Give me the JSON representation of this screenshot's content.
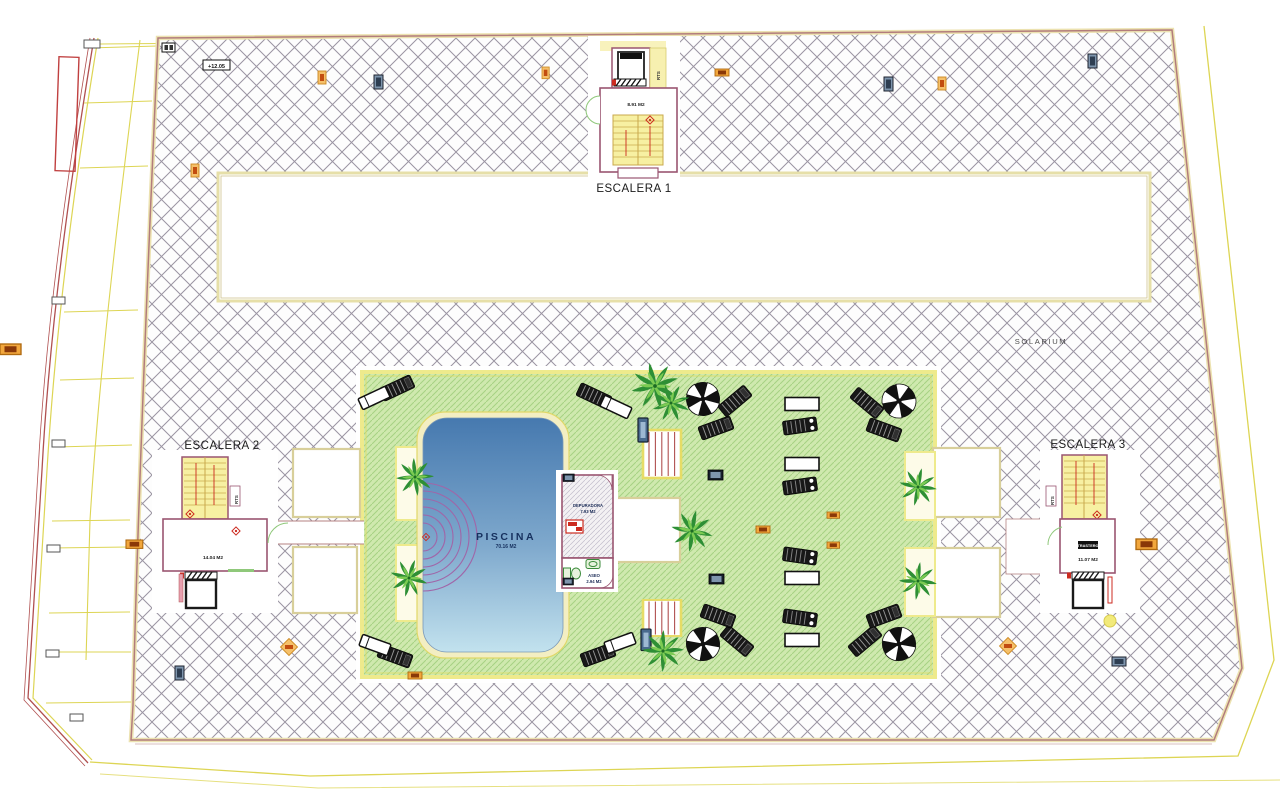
{
  "plan": {
    "solarium_label": "SOLARIUM",
    "piscina": {
      "title": "PISCINA",
      "area": "70.16 M2"
    },
    "escalera1": {
      "title": "ESCALERA 1",
      "area": "8.91 M2",
      "rts": "RTS"
    },
    "escalera2": {
      "title": "ESCALERA 2",
      "area": "14.04 M2",
      "rts": "RTS"
    },
    "escalera3": {
      "title": "ESCALERA 3",
      "area": "11.07 M2",
      "rts": "RTS",
      "storage": "TRASTERO"
    },
    "depuradora": {
      "title": "DEPURADORA",
      "area": "7.93 M2"
    },
    "aseo": {
      "title": "ASEO",
      "area": "2.94 M2"
    },
    "level_tag": "+12.05"
  },
  "colors": {
    "hatch_line": "#9a94a2",
    "boundary": "#b27c7c",
    "boundary_inner": "#ece2b0",
    "outer_yellow": "#ddd554",
    "green_fill": "#cfe9ae",
    "green_line": "#a6d283",
    "green_border": "#eeea8c",
    "pool_top": "#4a7bb2",
    "pool_bottom": "#bddfee",
    "pool_border": "#f3eec2",
    "wall": "#9a5571",
    "stair_fill": "#f7f0a2",
    "stair_line": "#c9a94c",
    "red_accent": "#cc2b20",
    "orange_badge": "#f2a73d",
    "navy_badge": "#7e95ad",
    "palm_dark": "#2e8f35",
    "palm_light": "#7ccb52"
  }
}
